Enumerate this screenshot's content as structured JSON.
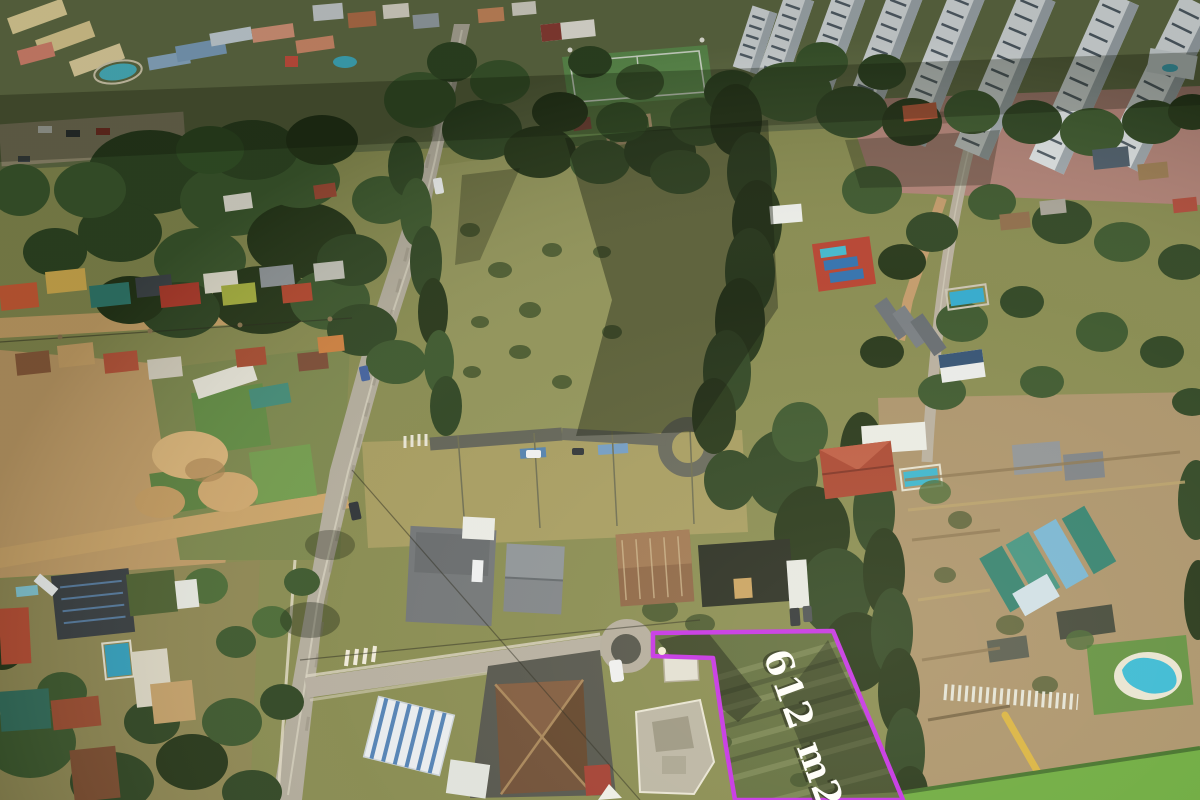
{
  "annotation": {
    "area_label": "612 m2",
    "outline_color": "#c42ee8",
    "label_color": "#ffffff",
    "label_shadow_color": "rgba(20,25,10,0.6)",
    "marker_color": "#f2ecd4"
  }
}
